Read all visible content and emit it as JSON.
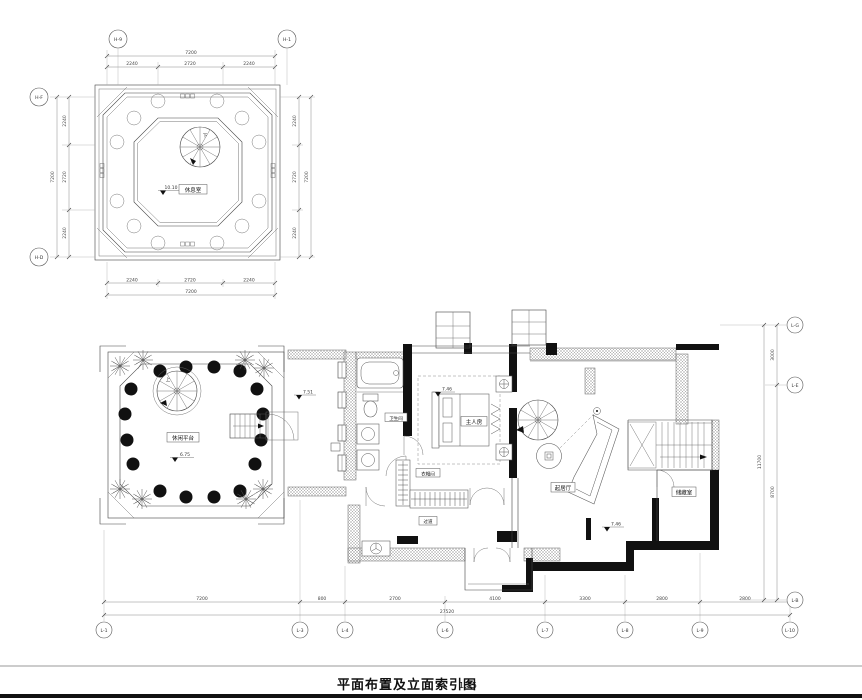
{
  "title_block": {
    "title": "平面布置及立面索引图",
    "scale": "1:75"
  },
  "levels": {
    "roof": "10.10",
    "site": "6.75",
    "terrace": "7.51",
    "bedroom": "7.46",
    "living": "7.46"
  },
  "roof_plan": {
    "room_label": "休息室",
    "stair_label": "下",
    "bubbles": {
      "top_left": "H-9",
      "top_right": "H-1",
      "left_top": "H-F",
      "left_bottom": "H-D"
    },
    "dims": {
      "segments": [
        "2240",
        "2720",
        "2240"
      ],
      "total": "7200"
    }
  },
  "site_plan": {
    "room_label": "休闲平台",
    "stair_label": "上"
  },
  "floor_plan": {
    "labels": {
      "bathroom": "卫生间",
      "bedroom": "主人房",
      "cloakroom": "衣帽间",
      "corridor": "过道",
      "living": "起居厅",
      "storage": "储藏室"
    },
    "grid_bottom": {
      "bubbles": [
        "L-1",
        "L-3",
        "L-4",
        "L-6",
        "L-7",
        "L-8",
        "L-9",
        "L-10"
      ],
      "segments": [
        "7200",
        "800",
        "2700",
        "4100",
        "3300",
        "2800",
        "2800"
      ],
      "total": "27520"
    },
    "grid_right": {
      "bubbles": [
        "L-G",
        "L-E",
        "L-B"
      ],
      "segments": [
        "3000",
        "8700"
      ],
      "total": "11700"
    }
  }
}
